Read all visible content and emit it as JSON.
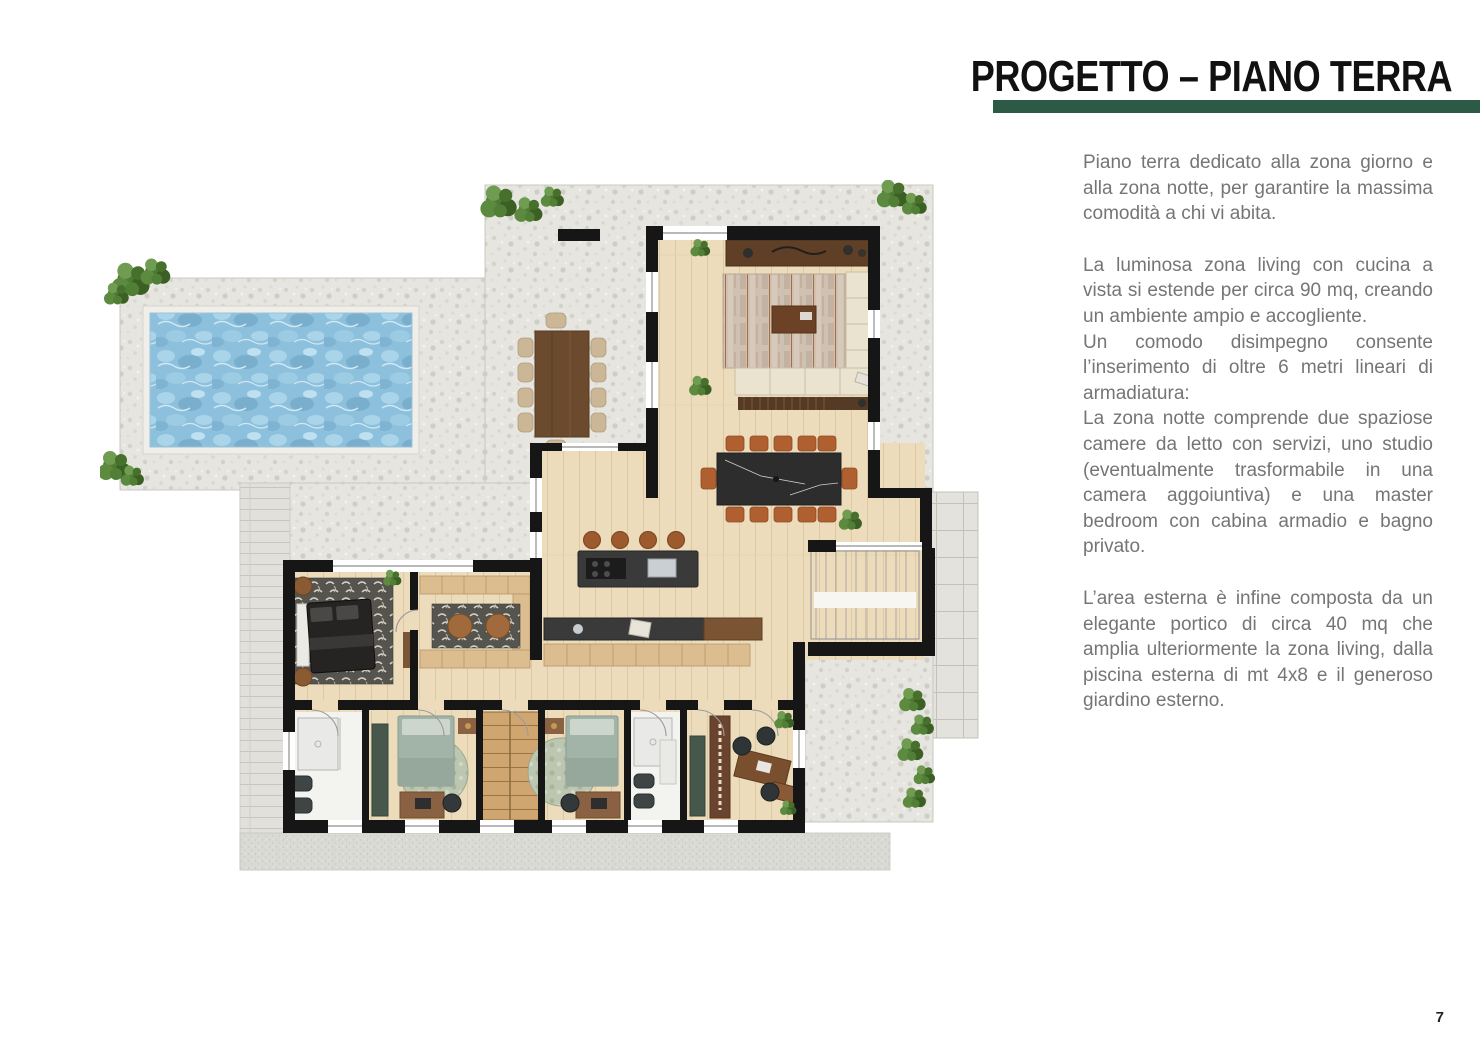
{
  "page": {
    "number": "7",
    "background": "#ffffff"
  },
  "header": {
    "title": "PROGETTO – PIANO TERRA",
    "title_color": "#111111",
    "accent_bar_color": "#2d5a46"
  },
  "article": {
    "text_color": "#757575",
    "paragraphs": [
      "Piano terra dedicato alla zona giorno e alla zona notte, per garantire la massima comodità a chi vi abita.",
      "La luminosa zona living con cucina a vista si estende per circa 90 mq, creando un ambiente ampio e accogliente.",
      "Un comodo disimpegno consente l’inserimento di oltre 6 metri lineari di armadiatura:",
      "La zona notte comprende due spaziose camere da letto con servizi, uno studio (eventualmente trasformabile in una camera aggoiuntiva) e una master bedroom con cabina armadio e bagno privato.",
      "L’area esterna è infine composta da un elegante portico di circa 40 mq che amplia ulteriormente la zona living, dalla piscina esterna di mt 4x8 e il generoso giardino esterno."
    ]
  },
  "floorplan": {
    "description": "ground-floor architectural plan: pool, stone terraces, living-dining area, kitchen island, staircase, master bedroom with walk-in closet, two bedrooms, two bathrooms, studio, portico and garden",
    "palette": {
      "terrace": "#e6e5e0",
      "grain": "#dadad5",
      "pool": "#8dc0dc",
      "pool-light": "#a9d4ea",
      "pool-dark": "#79aecd",
      "floor": "#ecdcbc",
      "floor-line": "#ddc9a2",
      "wall": "#161616",
      "plant": "#4e7a35",
      "plant-dark": "#3c5f24",
      "plant-light": "#6f9c50",
      "wood": "#6b4a2e",
      "wood-light": "#dcbd8f",
      "dark-surface": "#3a3a3a",
      "sofa": "#eae3d0",
      "chair-orange": "#b06030",
      "bed-green": "#a2b4a8",
      "cabinet-green": "#46584c",
      "rug-dark": "#56544e",
      "white-room": "#f3f3f0"
    }
  }
}
